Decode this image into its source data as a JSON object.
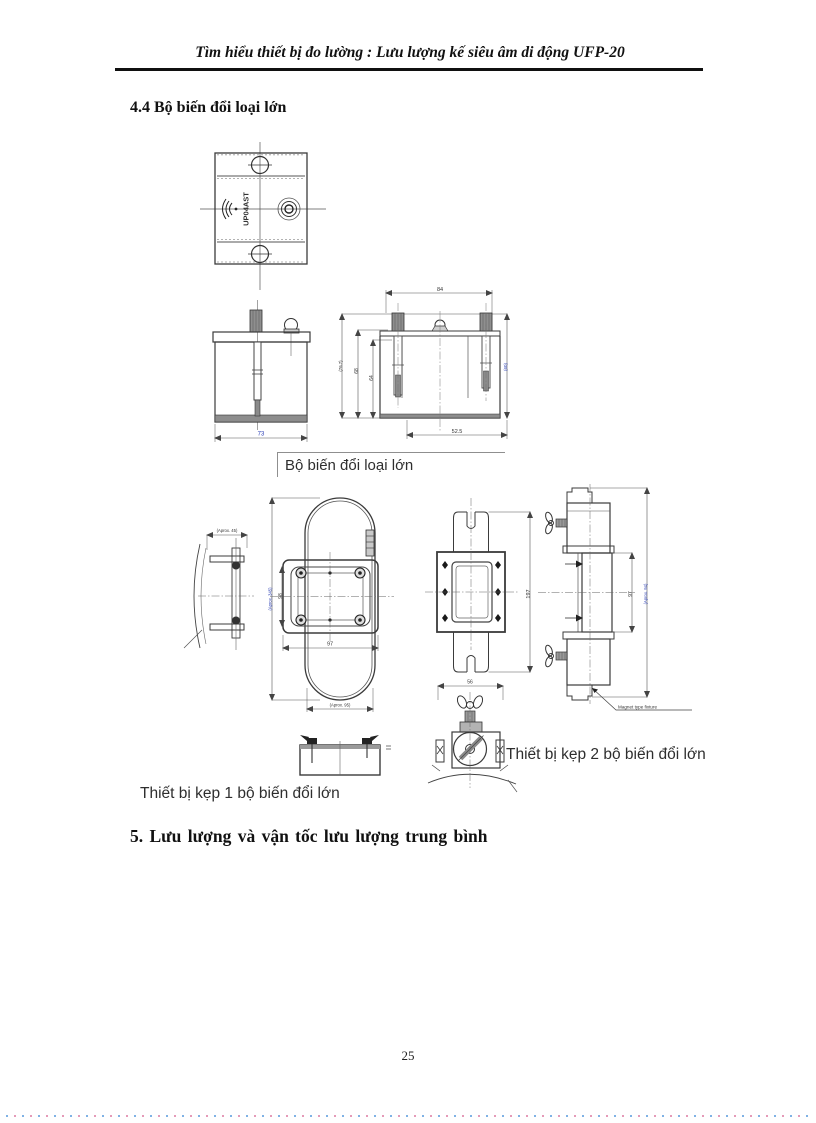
{
  "header": {
    "title": "Tìm hiểu thiết bị đo lường : Lưu lượng kế siêu âm di động UFP-20"
  },
  "sections": {
    "s44": "4.4 Bộ biến đổi loại lớn",
    "s5": "5. Lưu lượng và vận tốc lưu lượng trung bình"
  },
  "captions": {
    "transducer_box": "Bộ biến đổi loại lớn",
    "clamp1": "Thiết bị kẹp 1 bộ biến đổi lớn",
    "clamp2": "Thiết bị kẹp 2 bộ biến đổi lớn"
  },
  "footer": {
    "page_number": "25"
  },
  "drawings": {
    "top_view": {
      "marking": "UP04AST"
    },
    "side_view_small": {
      "width": "73"
    },
    "side_view_section": {
      "top_width": "84",
      "height_outer": "(76.7)",
      "height_mid": "68",
      "height_inner": "64",
      "height_right": "(60)",
      "bottom_width": "52.5"
    },
    "chain_clamp": {
      "side_width": "(Aprox. 45)",
      "overall_height": "(Aprox. 345)",
      "bracket_height": "98",
      "bracket_width": "97",
      "loop_width": "(Aprox. 95)"
    },
    "flange_plate": {
      "height": "197"
    },
    "clamp_side": {
      "block_height": "97",
      "overall_height": "(Aprox. 94)",
      "magnet_note": "Magnet type fixture"
    },
    "clamp_front": {
      "width": "56"
    }
  }
}
